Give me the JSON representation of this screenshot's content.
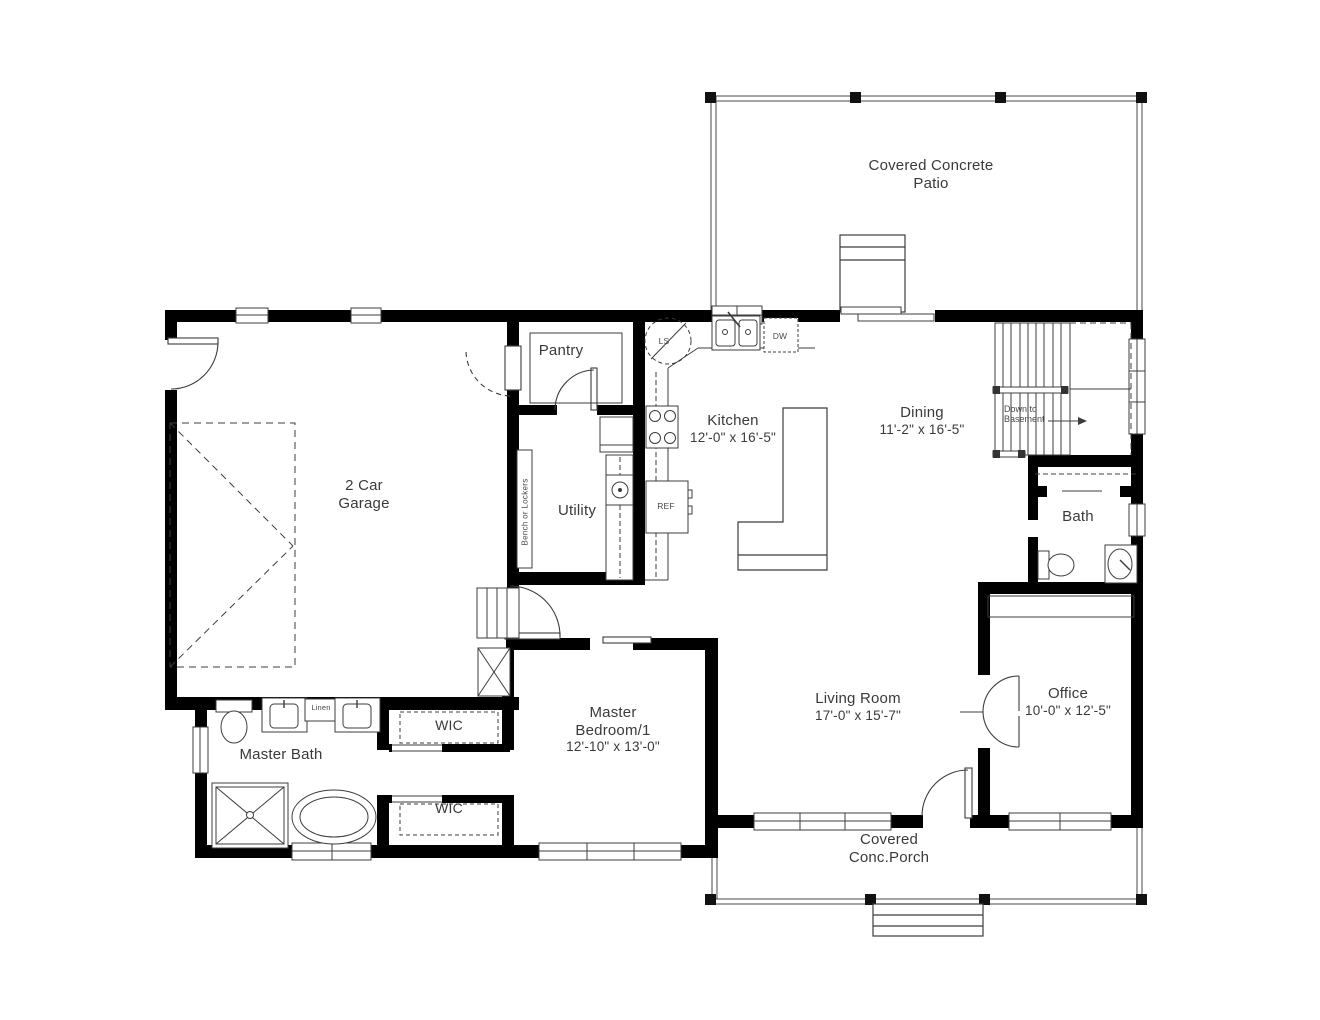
{
  "rooms": {
    "patio": {
      "name": "Covered Concrete Patio"
    },
    "garage": {
      "name": "2 Car Garage"
    },
    "pantry": {
      "name": "Pantry"
    },
    "utility": {
      "name": "Utility"
    },
    "kitchen": {
      "name": "Kitchen",
      "dims": "12'-0\" x 16'-5\""
    },
    "dining": {
      "name": "Dining",
      "dims": "11'-2\" x 16'-5\""
    },
    "bath": {
      "name": "Bath"
    },
    "office": {
      "name": "Office",
      "dims": "10'-0\" x 12'-5\""
    },
    "living_room": {
      "name": "Living Room",
      "dims": "17'-0\" x 15'-7\""
    },
    "master_bedroom": {
      "name": "Master Bedroom/1",
      "dims": "12'-10\" x 13'-0\""
    },
    "master_bath": {
      "name": "Master Bath"
    },
    "wic_upper": {
      "name": "WIC"
    },
    "wic_lower": {
      "name": "WIC"
    },
    "porch": {
      "name": "Covered Conc.Porch"
    }
  },
  "annotations": {
    "stairs_note": "Down to Basement",
    "bench_note": "Bench or Lockers",
    "linen": "Linen",
    "lazy_susan": "LS",
    "dishwasher": "DW",
    "refrigerator": "REF"
  },
  "colors": {
    "wall": "#000000",
    "line": "#3c3c3c",
    "text": "#3a3a3a",
    "background": "#ffffff"
  }
}
